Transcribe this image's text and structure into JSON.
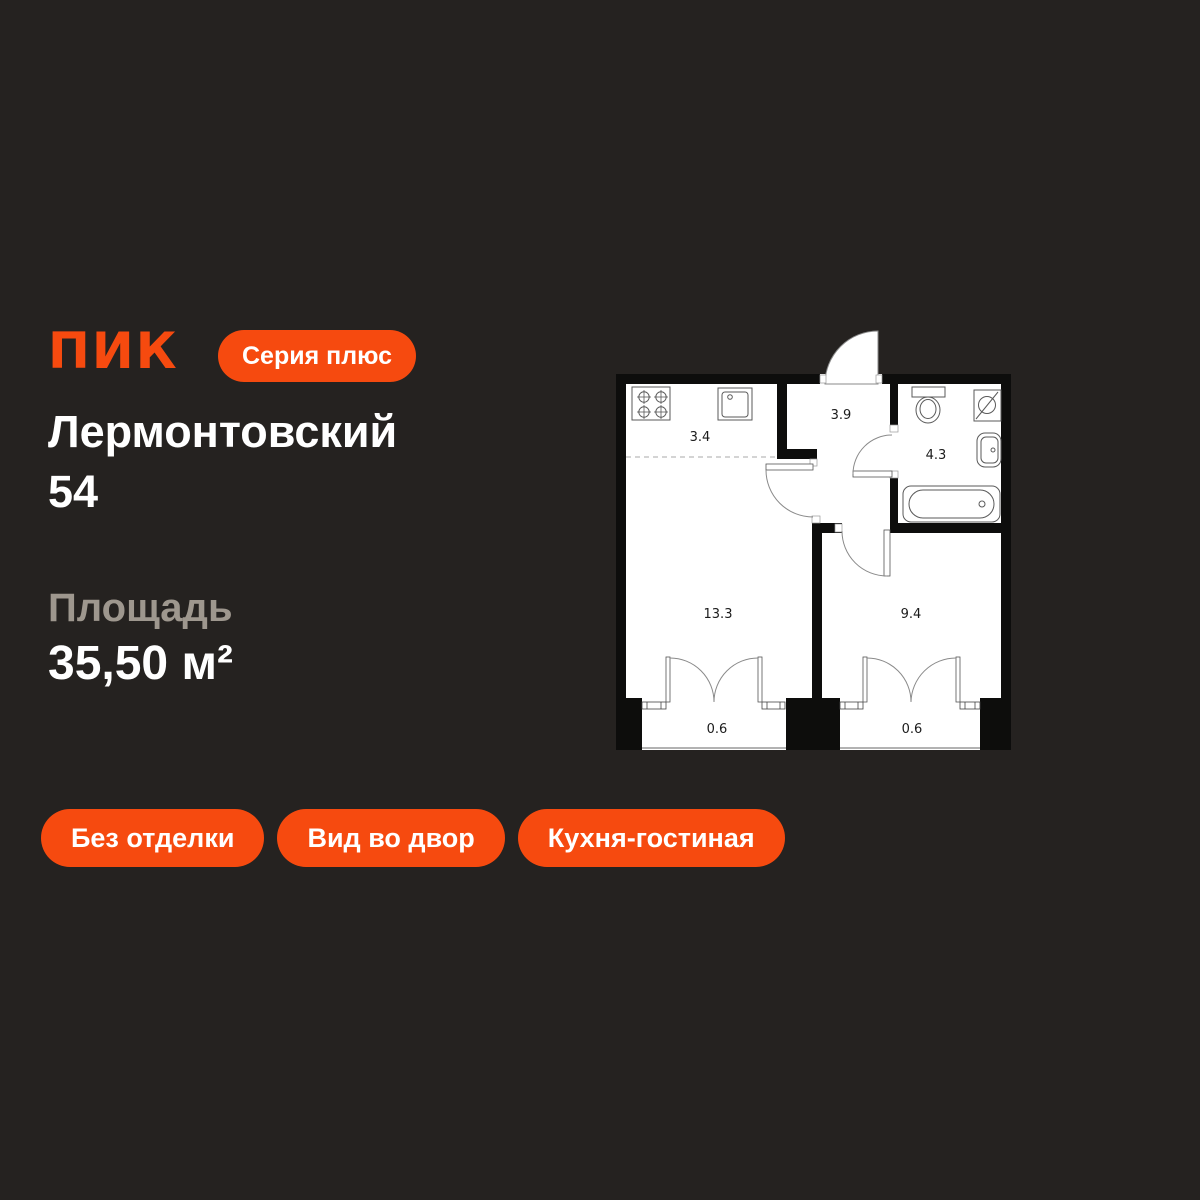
{
  "brand": {
    "logo": "ПИК",
    "series_badge": "Серия плюс"
  },
  "project": {
    "name_line1": "Лермонтовский",
    "name_line2": "54"
  },
  "area": {
    "label": "Площадь",
    "value": "35,50 м²"
  },
  "tags": [
    {
      "label": "Без отделки"
    },
    {
      "label": "Вид во двор"
    },
    {
      "label": "Кухня-гостиная"
    }
  ],
  "floorplan": {
    "rooms": [
      {
        "name": "kitchen",
        "area": "3.4"
      },
      {
        "name": "hallway",
        "area": "3.9"
      },
      {
        "name": "bathroom",
        "area": "4.3"
      },
      {
        "name": "living-room",
        "area": "13.3"
      },
      {
        "name": "bedroom",
        "area": "9.4"
      },
      {
        "name": "balcony-left",
        "area": "0.6"
      },
      {
        "name": "balcony-right",
        "area": "0.6"
      }
    ],
    "fixtures": [
      "stove",
      "kitchen-sink",
      "toilet",
      "washing-machine",
      "bathroom-sink",
      "bathtub"
    ]
  },
  "colors": {
    "background": "#252220",
    "accent": "#F64A0F",
    "muted_text": "#9E978E",
    "text": "#FFFFFF",
    "plan_background": "#FFFFFF",
    "plan_walls": "#0D0D0C"
  }
}
